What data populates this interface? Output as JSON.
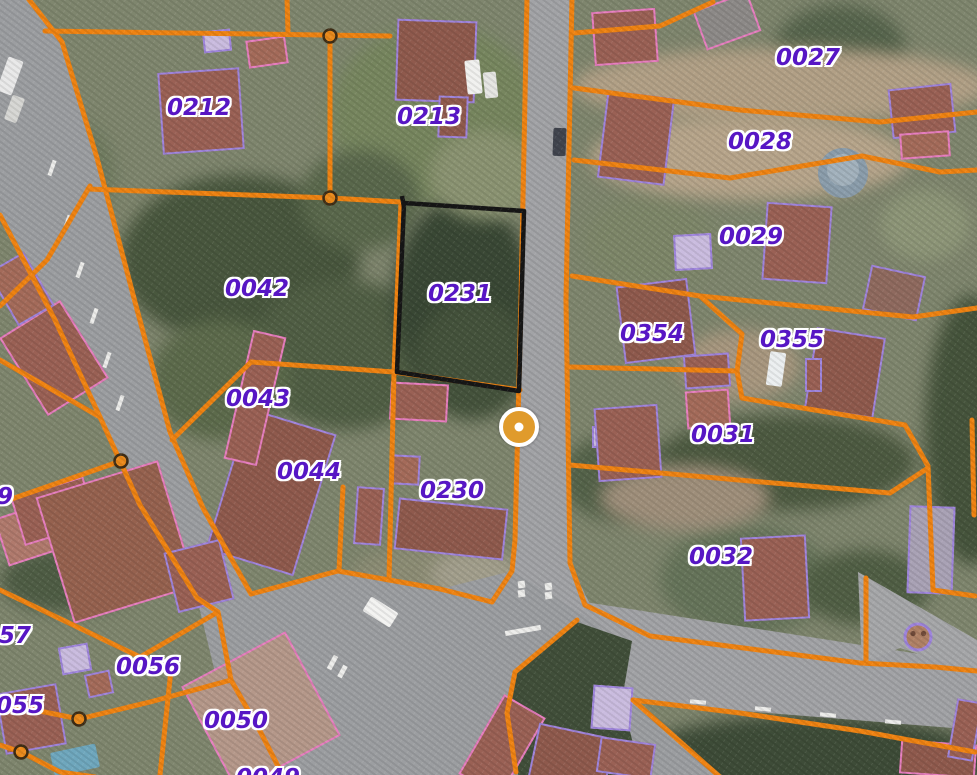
{
  "map": {
    "type": "cadastral-parcel-map-over-aerial-imagery",
    "selected_parcel": "0231",
    "parcel_labels": [
      {
        "text": "0212",
        "x": 199,
        "y": 108
      },
      {
        "text": "0213",
        "x": 429,
        "y": 117
      },
      {
        "text": "0027",
        "x": 808,
        "y": 58
      },
      {
        "text": "0028",
        "x": 760,
        "y": 142
      },
      {
        "text": "0029",
        "x": 751,
        "y": 237
      },
      {
        "text": "0042",
        "x": 257,
        "y": 289
      },
      {
        "text": "0231",
        "x": 460,
        "y": 294
      },
      {
        "text": "0354",
        "x": 652,
        "y": 334
      },
      {
        "text": "0355",
        "x": 792,
        "y": 340
      },
      {
        "text": "0043",
        "x": 258,
        "y": 399
      },
      {
        "text": "0031",
        "x": 723,
        "y": 435
      },
      {
        "text": "0044",
        "x": 309,
        "y": 472
      },
      {
        "text": "0230",
        "x": 452,
        "y": 491
      },
      {
        "text": "0032",
        "x": 721,
        "y": 557
      },
      {
        "text": "57",
        "x": 15,
        "y": 636
      },
      {
        "text": "0056",
        "x": 148,
        "y": 667
      },
      {
        "text": "0055",
        "x": 12,
        "y": 706
      },
      {
        "text": "0050",
        "x": 236,
        "y": 721
      },
      {
        "text": "0049",
        "x": 268,
        "y": 778
      },
      {
        "text": "9",
        "x": 5,
        "y": 497
      }
    ],
    "marker": {
      "x": 519,
      "y": 427
    },
    "colors": {
      "parcel_line": "#ef8312",
      "parcel_node_fill": "#ea8a1c",
      "label_text": "#5716c4",
      "selection_outline": "#161616",
      "building_outline_violet": "#9f85dd",
      "building_outline_pink": "#e77fc0",
      "marker_fill": "#e09b2c"
    }
  }
}
